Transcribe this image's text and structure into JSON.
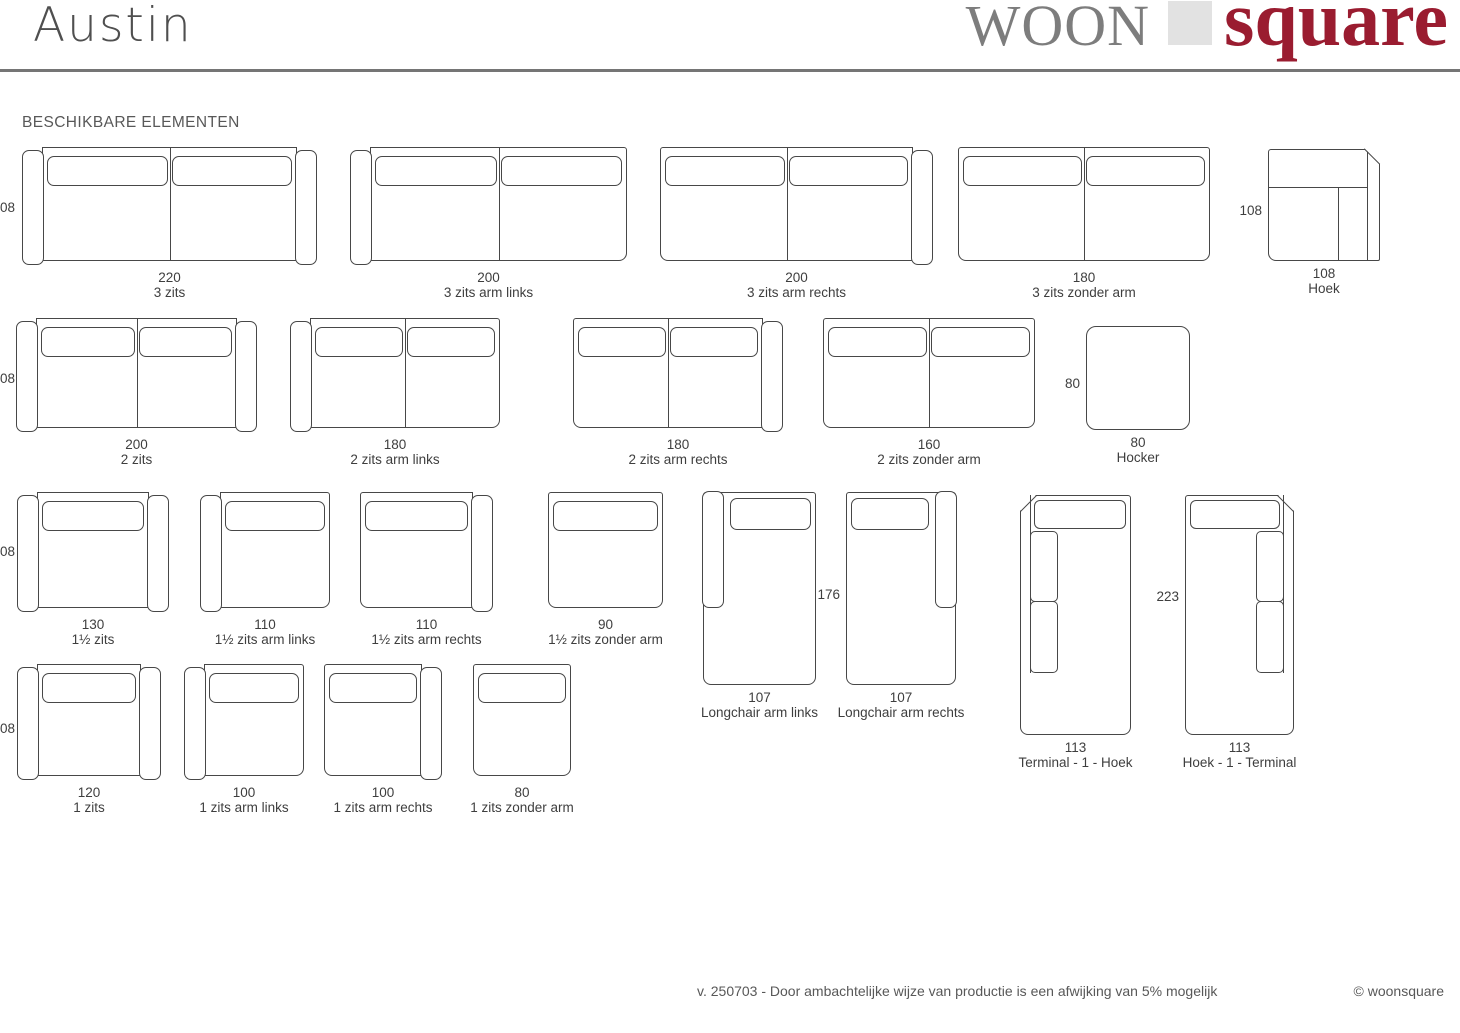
{
  "page": {
    "title": "Austin",
    "section_title": "BESCHIKBARE ELEMENTEN"
  },
  "logo": {
    "gray_text": "WOON",
    "red_text": "square"
  },
  "footer": {
    "note": "v. 250703 - Door ambachtelijke wijze van productie is een afwijking van 5% mogelijk",
    "copyright": "© woonsquare"
  },
  "colors": {
    "line": "#474747",
    "text": "#3e3e3e",
    "muted": "#585858",
    "logo_gray": "#7d7d7d",
    "logo_red": "#9a1c30",
    "logo_block": "#e2e2e2",
    "divider": "#757575"
  },
  "edge_dims": [
    {
      "text": "08",
      "top": 200
    },
    {
      "text": "08",
      "top": 371
    },
    {
      "text": "08",
      "top": 544
    },
    {
      "text": "08",
      "top": 721
    }
  ],
  "elements": [
    {
      "id": "3-zits",
      "label": "3 zits",
      "dim": "220",
      "variant": "sofa",
      "arms": "both",
      "sections": 2,
      "x": 22,
      "y": 147,
      "w": 295,
      "h": 118
    },
    {
      "id": "3-zits-arm-links",
      "label": "3 zits arm links",
      "dim": "200",
      "variant": "sofa",
      "arms": "left",
      "sections": 2,
      "x": 350,
      "y": 147,
      "w": 277,
      "h": 118
    },
    {
      "id": "3-zits-arm-rechts",
      "label": "3 zits arm rechts",
      "dim": "200",
      "variant": "sofa",
      "arms": "right",
      "sections": 2,
      "x": 660,
      "y": 147,
      "w": 273,
      "h": 118
    },
    {
      "id": "3-zits-zonder-arm",
      "label": "3 zits zonder arm",
      "dim": "180",
      "variant": "sofa",
      "arms": "none",
      "sections": 2,
      "x": 958,
      "y": 147,
      "w": 252,
      "h": 118
    },
    {
      "id": "hoek",
      "label": "Hoek",
      "dim": "108",
      "variant": "hoek",
      "side_dim": "108",
      "x": 1268,
      "y": 149,
      "w": 112,
      "h": 112
    },
    {
      "id": "2-zits",
      "label": "2 zits",
      "dim": "200",
      "variant": "sofa",
      "arms": "both",
      "sections": 2,
      "x": 16,
      "y": 318,
      "w": 241,
      "h": 114
    },
    {
      "id": "2-zits-arm-links",
      "label": "2 zits arm links",
      "dim": "180",
      "variant": "sofa",
      "arms": "left",
      "sections": 2,
      "x": 290,
      "y": 318,
      "w": 210,
      "h": 114
    },
    {
      "id": "2-zits-arm-rechts",
      "label": "2 zits arm rechts",
      "dim": "180",
      "variant": "sofa",
      "arms": "right",
      "sections": 2,
      "x": 573,
      "y": 318,
      "w": 210,
      "h": 114
    },
    {
      "id": "2-zits-zonder-arm",
      "label": "2 zits zonder arm",
      "dim": "160",
      "variant": "sofa",
      "arms": "none",
      "sections": 2,
      "x": 823,
      "y": 318,
      "w": 212,
      "h": 114
    },
    {
      "id": "hocker",
      "label": "Hocker",
      "dim": "80",
      "variant": "hocker",
      "side_dim": "80",
      "x": 1086,
      "y": 326,
      "w": 104,
      "h": 104
    },
    {
      "id": "1half-zits",
      "label": "1½ zits",
      "dim": "130",
      "variant": "sofa",
      "arms": "both",
      "sections": 1,
      "x": 17,
      "y": 492,
      "w": 152,
      "h": 120
    },
    {
      "id": "1half-zits-arm-links",
      "label": "1½ zits arm links",
      "dim": "110",
      "variant": "sofa",
      "arms": "left",
      "sections": 1,
      "x": 200,
      "y": 492,
      "w": 130,
      "h": 120
    },
    {
      "id": "1half-zits-arm-rechts",
      "label": "1½ zits arm rechts",
      "dim": "110",
      "variant": "sofa",
      "arms": "right",
      "sections": 1,
      "x": 360,
      "y": 492,
      "w": 133,
      "h": 120
    },
    {
      "id": "1half-zits-zonder-arm",
      "label": "1½ zits zonder arm",
      "dim": "90",
      "variant": "sofa",
      "arms": "none",
      "sections": 1,
      "x": 548,
      "y": 492,
      "w": 115,
      "h": 120
    },
    {
      "id": "longchair-arm-links",
      "label": "Longchair arm links",
      "dim": "107",
      "variant": "longchair",
      "arm": "left",
      "x": 703,
      "y": 492,
      "w": 113,
      "h": 193
    },
    {
      "id": "longchair-arm-rechts",
      "label": "Longchair arm rechts",
      "dim": "107",
      "variant": "longchair",
      "arm": "right",
      "side_dim": "176",
      "x": 846,
      "y": 492,
      "w": 110,
      "h": 193
    },
    {
      "id": "terminal-1-hoek",
      "label": "Terminal - 1 - Hoek",
      "dim": "113",
      "variant": "terminal",
      "side": "left",
      "x": 1020,
      "y": 495,
      "w": 111,
      "h": 240
    },
    {
      "id": "hoek-1-terminal",
      "label": "Hoek - 1 - Terminal",
      "dim": "113",
      "variant": "terminal",
      "side": "right",
      "side_dim": "223",
      "x": 1185,
      "y": 495,
      "w": 109,
      "h": 240
    },
    {
      "id": "1-zits",
      "label": "1 zits",
      "dim": "120",
      "variant": "sofa",
      "arms": "both",
      "sections": 1,
      "x": 17,
      "y": 664,
      "w": 144,
      "h": 116
    },
    {
      "id": "1-zits-arm-links",
      "label": "1 zits arm links",
      "dim": "100",
      "variant": "sofa",
      "arms": "left",
      "sections": 1,
      "x": 184,
      "y": 664,
      "w": 120,
      "h": 116
    },
    {
      "id": "1-zits-arm-rechts",
      "label": "1 zits arm rechts",
      "dim": "100",
      "variant": "sofa",
      "arms": "right",
      "sections": 1,
      "x": 324,
      "y": 664,
      "w": 118,
      "h": 116
    },
    {
      "id": "1-zits-zonder-arm",
      "label": "1 zits zonder arm",
      "dim": "80",
      "variant": "sofa",
      "arms": "none",
      "sections": 1,
      "x": 473,
      "y": 664,
      "w": 98,
      "h": 116
    }
  ]
}
